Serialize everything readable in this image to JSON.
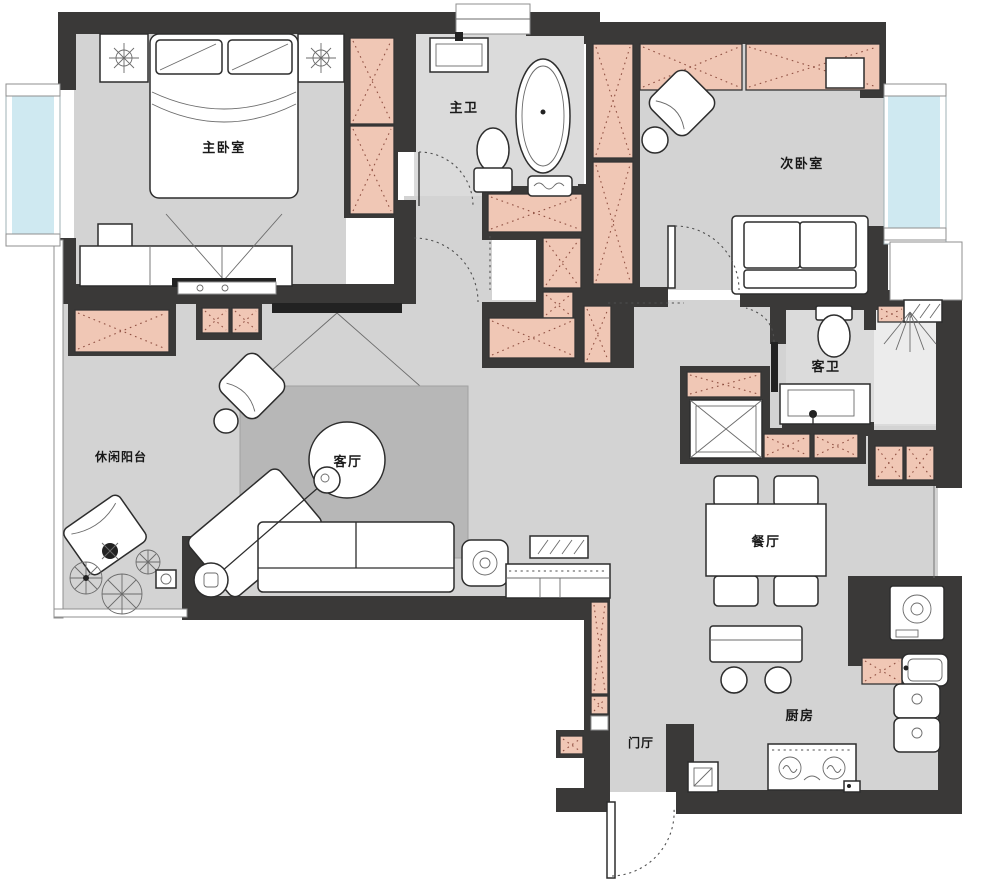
{
  "plan_title": "two-bedroom apartment floor plan",
  "rooms": {
    "master_bedroom": {
      "label": "主卧室"
    },
    "master_bathroom": {
      "label": "主卫"
    },
    "second_bedroom": {
      "label": "次卧室"
    },
    "leisure_balcony": {
      "label": "休闲阳台"
    },
    "living_room": {
      "label": "客厅"
    },
    "guest_bathroom": {
      "label": "客卫"
    },
    "dining_room": {
      "label": "餐厅"
    },
    "kitchen": {
      "label": "厨房"
    },
    "entry_hall": {
      "label": "门厅"
    }
  },
  "colors": {
    "wall": "#3a3938",
    "floor": "#d3d3d3",
    "floor_light": "#dbdbdb",
    "shower_floor": "#ececec",
    "rug": "#b7b7b7",
    "cabinet": "#f0c7b5",
    "cabinet_dot": "#8a4a3c",
    "window_glass": "#cfe9f1",
    "line": "#2d2d2d",
    "background": "#ffffff"
  }
}
